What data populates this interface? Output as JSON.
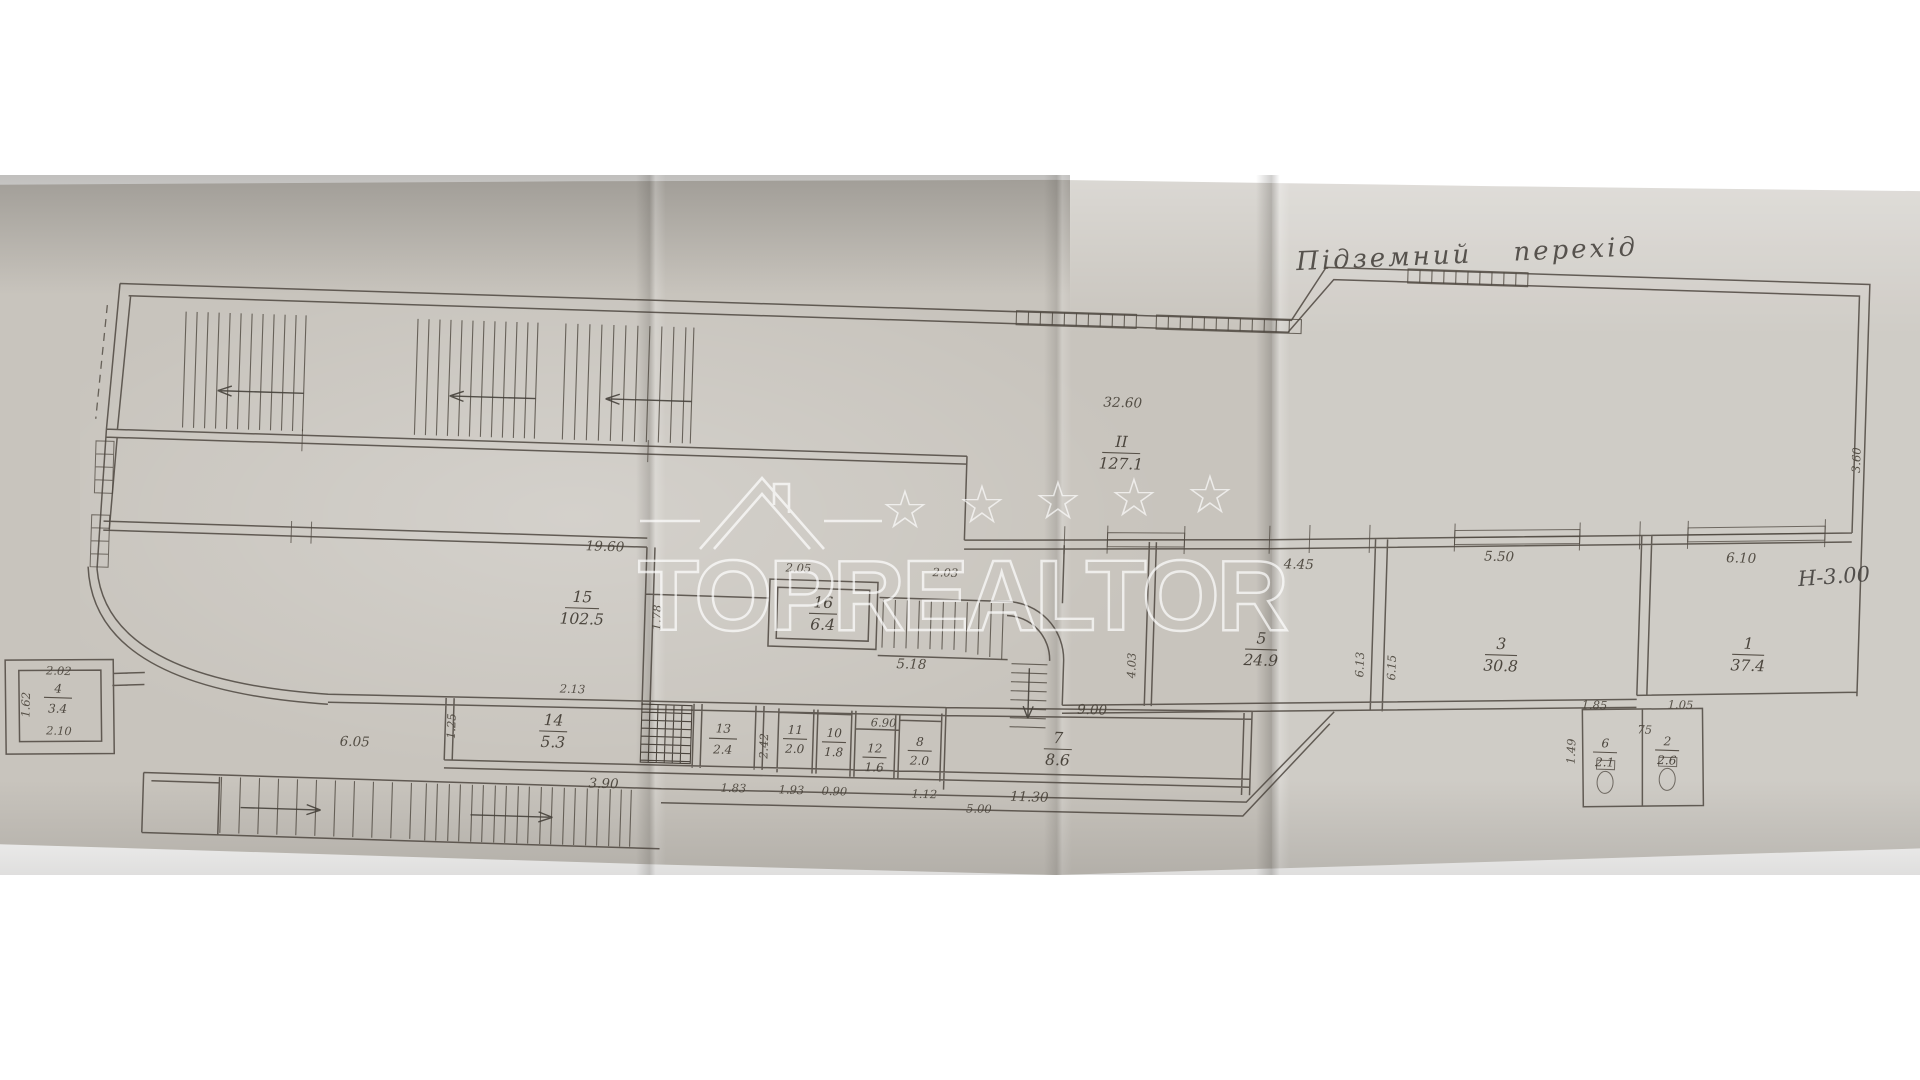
{
  "title": {
    "handwritten": "Підземний перехід",
    "height_note": "Н-3.00"
  },
  "watermark": {
    "text": "TOPREALTOR",
    "star": "☆"
  },
  "rooms": [
    {
      "num": "II",
      "area": "127.1"
    },
    {
      "num": "15",
      "area": "102.5"
    },
    {
      "num": "16",
      "area": "6.4"
    },
    {
      "num": "14",
      "area": "5.3"
    },
    {
      "num": "13",
      "area": "2.4"
    },
    {
      "num": "11",
      "area": "2.0"
    },
    {
      "num": "10",
      "area": "1.8"
    },
    {
      "num": "12",
      "area": "1.6"
    },
    {
      "num": "8",
      "area": "2.0"
    },
    {
      "num": "7",
      "area": "8.6"
    },
    {
      "num": "5",
      "area": "24.9"
    },
    {
      "num": "3",
      "area": "30.8"
    },
    {
      "num": "1",
      "area": "37.4"
    },
    {
      "num": "4",
      "area": "3.4"
    },
    {
      "num": "6",
      "area": "2.1"
    },
    {
      "num": "2",
      "area": "2.6"
    }
  ],
  "dims": {
    "top_length": "32.60",
    "room15_width": "19.60",
    "r16_top": "2.05",
    "stair_top": "2.03",
    "r16_left": "1.78",
    "stair_width": "5.18",
    "corr": "4.45",
    "win3": "5.50",
    "win1": "6.10",
    "right_h": "3.60",
    "r5_left": "4.03",
    "r5_right": "6.13",
    "r3_left": "6.15",
    "r14_top": "2.13",
    "r14_bot": "3.90",
    "r14_left": "1.25",
    "r13_bot": "1.83",
    "v2_42": "2.42",
    "r11_bot": "1.93",
    "r10_bot": "0.90",
    "r8_top": "6.90",
    "r12_bot": "1.12",
    "r7_top": "9.00",
    "r7_bot": "11.30",
    "strip": "5.00",
    "bottom_corr": "6.05",
    "r4_top": "2.02",
    "r4_bot": "2.10",
    "r4_left": "1.62",
    "wc_left_top": "1.85",
    "wc_right_top": "1.05",
    "wc_mid": "75",
    "wc_left": "1.49"
  }
}
